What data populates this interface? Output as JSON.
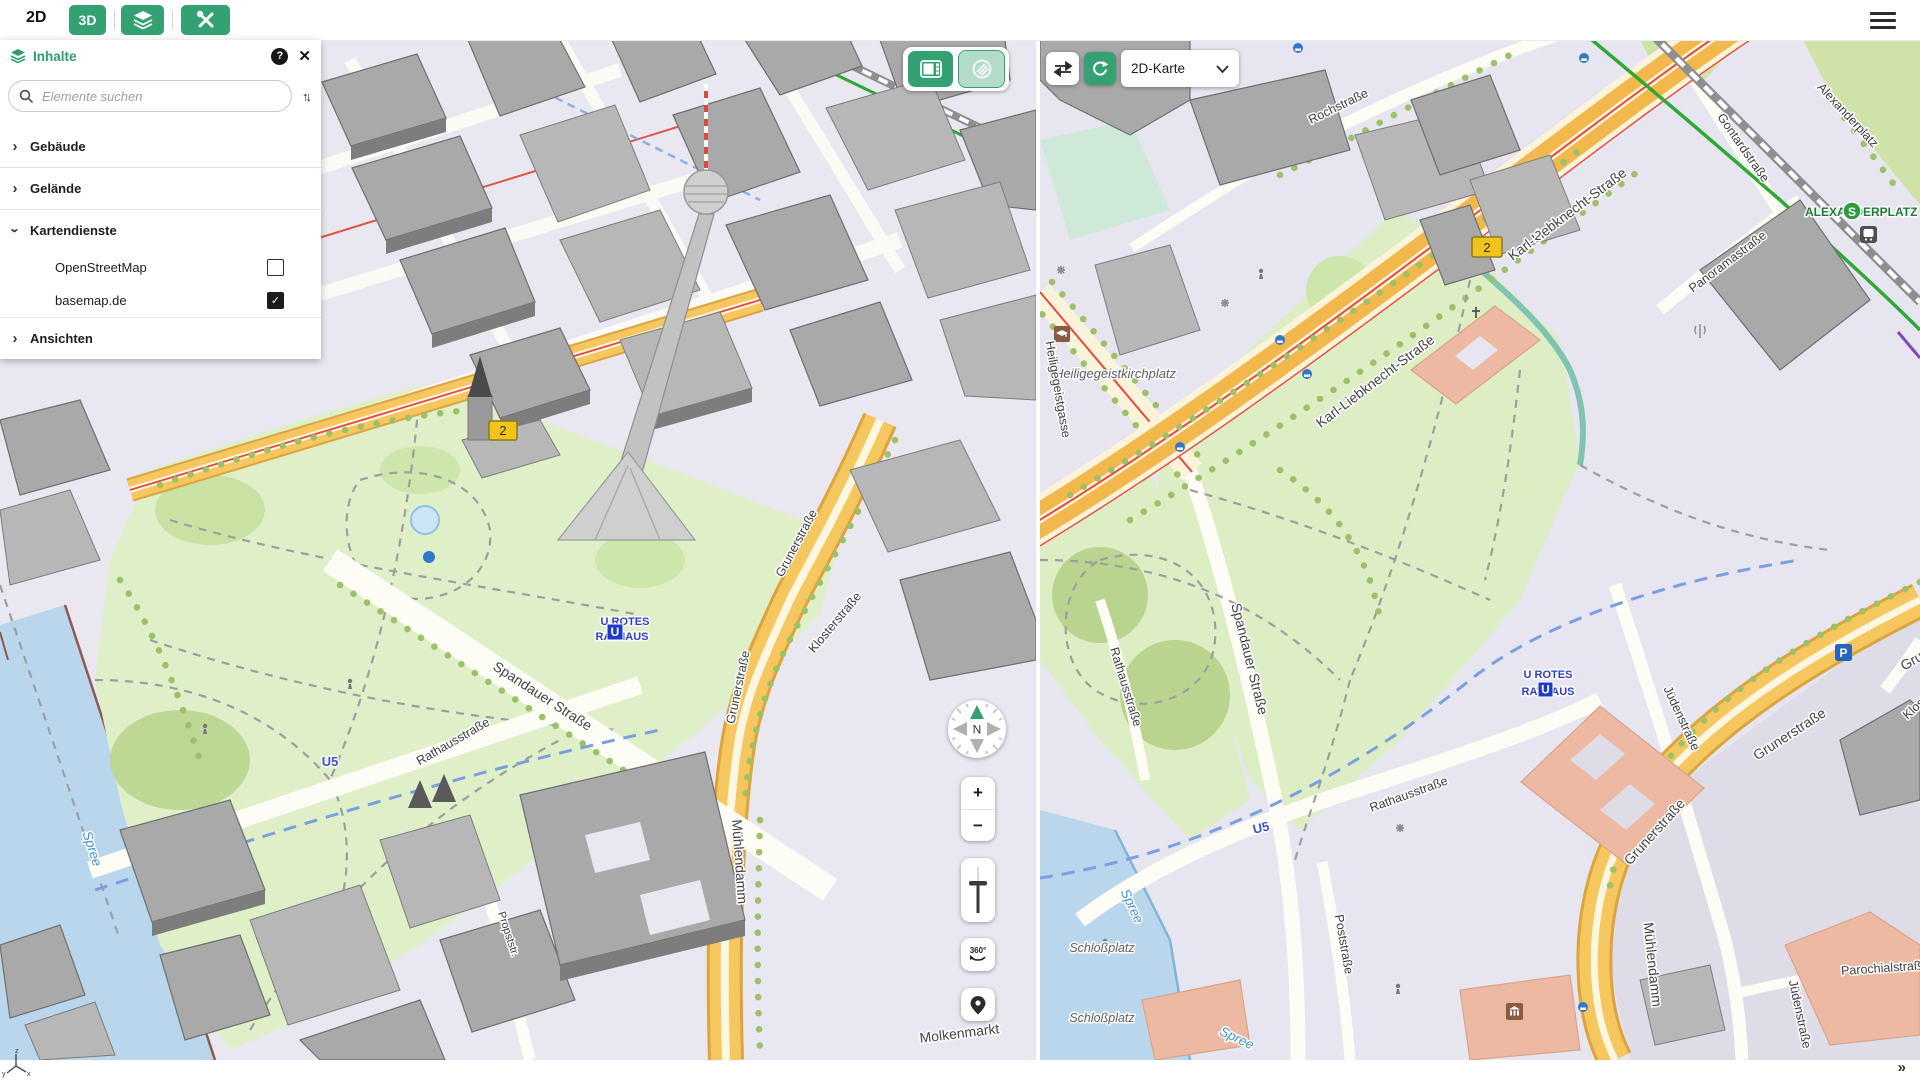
{
  "toolbar": {
    "mode_2d_label": "2D",
    "mode_3d_label": "3D"
  },
  "panel": {
    "title": "Inhalte",
    "help_icon": "?",
    "close_icon": "✕",
    "search_placeholder": "Elemente suchen",
    "sort_icon": "↑↓",
    "collapse_icon": "›",
    "check_icon": "✓",
    "items": [
      {
        "label": "Gebäude",
        "expanded": false
      },
      {
        "label": "Gelände",
        "expanded": false
      },
      {
        "label": "Kartendienste",
        "expanded": true
      },
      {
        "label": "OpenStreetMap",
        "checked": false
      },
      {
        "label": "basemap.de",
        "checked": true
      },
      {
        "label": "Ansichten",
        "expanded": false
      }
    ]
  },
  "left_map": {
    "controls": {
      "compass_north": "N",
      "zoom_in": "+",
      "zoom_out": "−",
      "rotate_label": "360°"
    },
    "labels": {
      "route_badge": "2",
      "spandauer": "Spandauer Straße",
      "rathausstrasse": "Rathausstraße",
      "grunerstrasse": "Grunerstraße",
      "muehlendamm": "Mühlendamm",
      "molkenmarkt": "Molkenmarkt",
      "propststrasse": "Propststr.",
      "klosterstrasse": "Klosterstraße",
      "spree": "Spree",
      "u5": "U5",
      "station_line1": "U ROTES",
      "station_line2": "RATHAUS",
      "ubahn_logo": "U"
    }
  },
  "right_map": {
    "view_selector_label": "2D-Karte",
    "labels": {
      "karl_liebknecht": "Karl-Liebknecht-Straße",
      "rochstrasse": "Rochstraße",
      "alexanderplatz": "Alexanderplatz",
      "gontardstrasse": "Gontardstraße",
      "panoramastrasse": "Panoramastraße",
      "sbahn_station": "ALEXANDERPLATZ",
      "sbahn_logo": "S",
      "heiligegeistkirchplatz": "Heiligegeistkirchplatz",
      "heiligegeistgasse": "Heiligegeistgasse",
      "spandauer": "Spandauer Straße",
      "rathausstrasse": "Rathausstraße",
      "juedenstrasse": "Jüdenstraße",
      "grunerstrasse": "Grunerstraße",
      "klosterstrasse": "Klosterstraße",
      "poststrasse": "Poststraße",
      "muehlendamm": "Mühlendamm",
      "parochialstrasse": "Parochialstraße",
      "schlossplatz": "Schloßplatz",
      "spree": "Spree",
      "u5": "U5",
      "station_line1": "U ROTES",
      "station_line2": "RATHAUS",
      "ubahn_logo": "U",
      "parking": "P",
      "route_badge": "2",
      "route_number": "2"
    }
  },
  "footer": {
    "expand_icon": "»",
    "axis_x": "x",
    "axis_y": "y",
    "axis_z": "z"
  },
  "colors": {
    "accent_green": "#34a173",
    "road_yellow": "#f6c75f",
    "road_orange": "#f2b84b",
    "park_green": "#ddedc4",
    "water_blue": "#b9d6ec",
    "building_gray": "#a9a9a9",
    "building_salmon": "#edb9a2",
    "ubahn_blue": "#2038c8",
    "sbahn_green": "#2e9a3c",
    "tram_red": "#e8483d"
  }
}
